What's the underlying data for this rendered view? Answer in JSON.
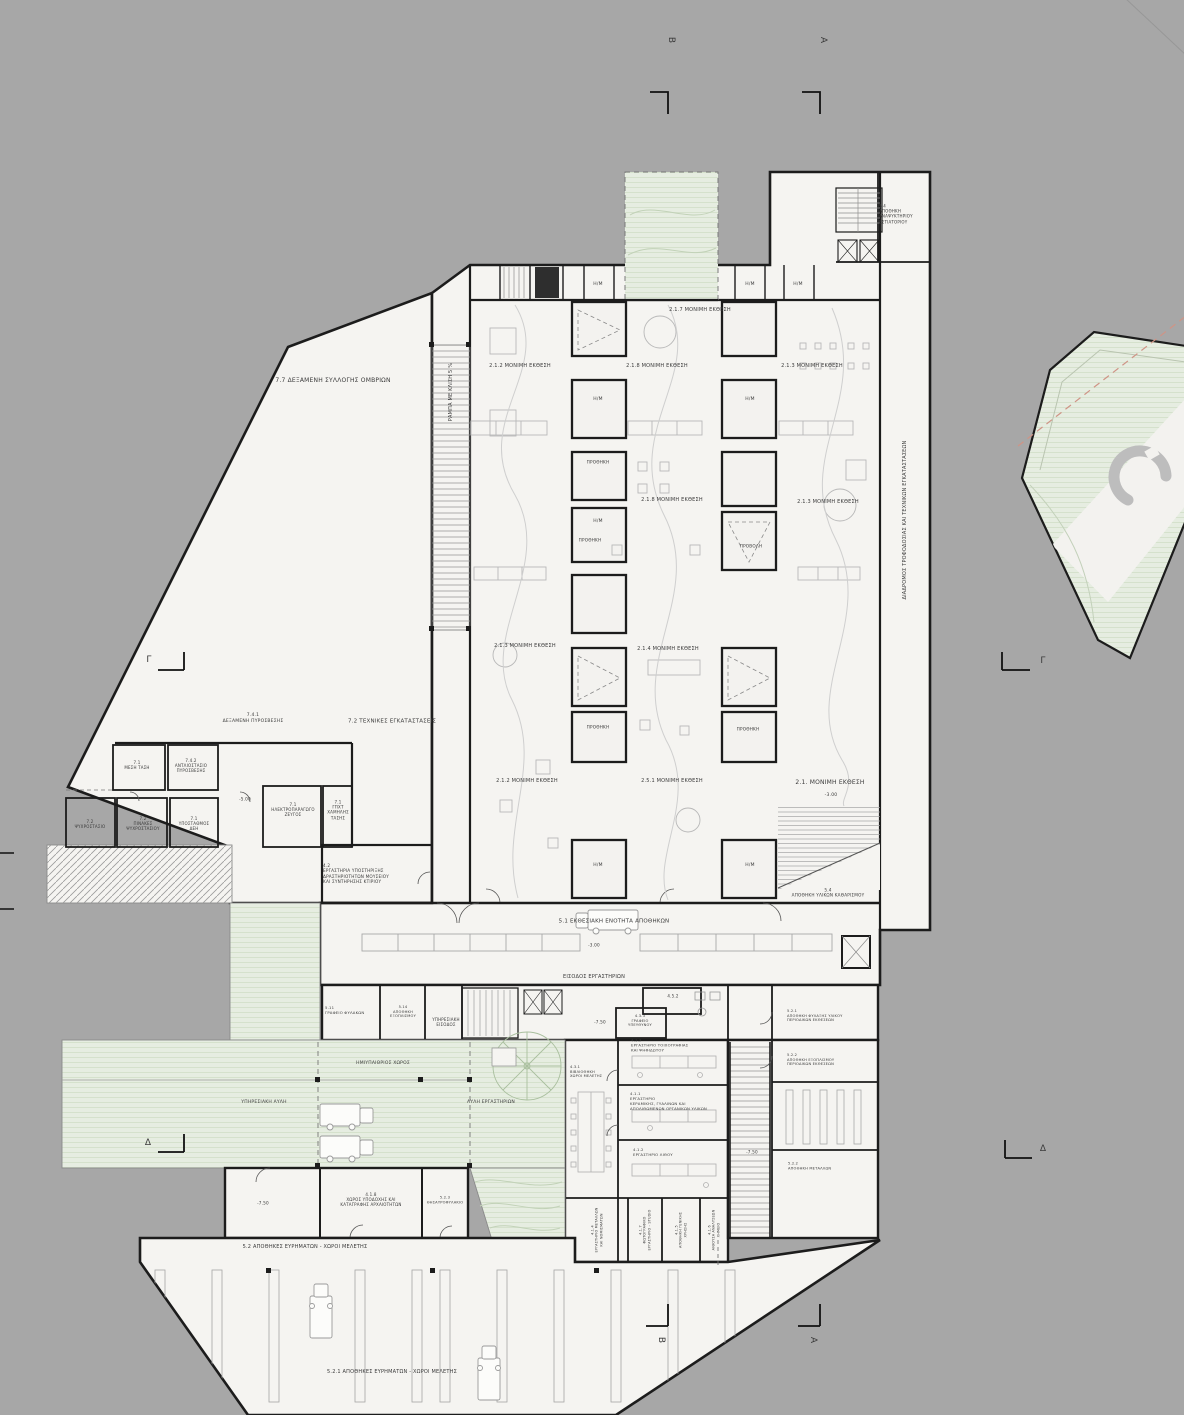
{
  "title": "Museum basement floor plan (Greek annotations)",
  "colors": {
    "background": "#a7a7a7",
    "paper": "#f5f4f1",
    "wall": "#1c1c1c",
    "green": "#e6ede1",
    "green_line": "#d5e1cc",
    "furniture": "#b5b5b5",
    "hatch": "#9b9b9b",
    "dashed_accent": "#cf9486",
    "text": "#3a3a3a"
  },
  "labels": [
    {
      "name": "section-letter-b-top",
      "text": "Β",
      "x": 670,
      "y": 40,
      "fs": 9,
      "rot": 90
    },
    {
      "name": "section-letter-a-top",
      "text": "Α",
      "x": 822,
      "y": 40,
      "fs": 9,
      "rot": 90
    },
    {
      "name": "section-letter-g-left",
      "text": "Γ",
      "x": 149,
      "y": 661,
      "fs": 9
    },
    {
      "name": "section-letter-g-right",
      "text": "Γ",
      "x": 1043,
      "y": 662,
      "fs": 9
    },
    {
      "name": "section-letter-d-left",
      "text": "Δ",
      "x": 148,
      "y": 1144,
      "fs": 9
    },
    {
      "name": "section-letter-d-right",
      "text": "Δ",
      "x": 1043,
      "y": 1150,
      "fs": 9
    },
    {
      "name": "section-letter-b-bottom",
      "text": "Β",
      "x": 660,
      "y": 1340,
      "fs": 9,
      "rot": 90
    },
    {
      "name": "section-letter-a-bottom",
      "text": "Α",
      "x": 812,
      "y": 1340,
      "fs": 9,
      "rot": 90
    },
    {
      "name": "room-7-7-rainwater-tank",
      "text": "7.7 ΔΕΞΑΜΕΝΗ ΣΥΛΛΟΓΗΣ ΟΜΒΡΙΩΝ",
      "x": 333,
      "y": 381,
      "fs": 6,
      "w": 220
    },
    {
      "name": "ramp-slope-label",
      "text": "ΡΑΜΠΑ ΜΕ ΚΛΙΣΗ 5 %",
      "x": 451,
      "y": 392,
      "fs": 5,
      "rot": -90,
      "w": 90
    },
    {
      "name": "exhibit-2-1-7",
      "text": "2.1.7 ΜΟΝΙΜΗ ΕΚΘΕΣΗ",
      "x": 700,
      "y": 310,
      "fs": 5,
      "w": 130
    },
    {
      "name": "exhibit-2-1-2-a",
      "text": "2.1.2 ΜΟΝΙΜΗ ΕΚΘΕΣΗ",
      "x": 520,
      "y": 366,
      "fs": 5,
      "w": 130
    },
    {
      "name": "exhibit-2-1-8-a",
      "text": "2.1.8 ΜΟΝΙΜΗ ΕΚΘΕΣΗ",
      "x": 657,
      "y": 366,
      "fs": 5,
      "w": 130
    },
    {
      "name": "exhibit-2-1-3-a",
      "text": "2.1.3 ΜΟΝΙΜΗ ΕΚΘΕΣΗ",
      "x": 812,
      "y": 366,
      "fs": 5,
      "w": 130
    },
    {
      "name": "exhibit-2-1-8-b",
      "text": "2.1.8 ΜΟΝΙΜΗ ΕΚΘΕΣΗ",
      "x": 672,
      "y": 500,
      "fs": 5,
      "w": 130
    },
    {
      "name": "exhibit-2-1-3-b",
      "text": "2.1.3 ΜΟΝΙΜΗ ΕΚΘΕΣΗ",
      "x": 828,
      "y": 502,
      "fs": 5,
      "w": 130
    },
    {
      "name": "exhibit-2-1-3-c",
      "text": "2.1.3 ΜΟΝΙΜΗ ΕΚΘΕΣΗ",
      "x": 525,
      "y": 646,
      "fs": 5,
      "w": 130
    },
    {
      "name": "exhibit-2-1-4",
      "text": "2.1.4 ΜΟΝΙΜΗ ΕΚΘΕΣΗ",
      "x": 668,
      "y": 649,
      "fs": 5,
      "w": 130
    },
    {
      "name": "exhibit-2-1-2-b",
      "text": "2.1.2 ΜΟΝΙΜΗ ΕΚΘΕΣΗ",
      "x": 527,
      "y": 781,
      "fs": 5,
      "w": 130
    },
    {
      "name": "exhibit-2-5-1",
      "text": "2.5.1 ΜΟΝΙΜΗ ΕΚΘΕΣΗ",
      "x": 672,
      "y": 781,
      "fs": 5,
      "w": 130
    },
    {
      "name": "exhibit-2-1-main",
      "text": "2.1. ΜΟΝΙΜΗ ΕΚΘΕΣΗ",
      "x": 830,
      "y": 783,
      "fs": 6,
      "w": 140
    },
    {
      "name": "level-marker",
      "text": "-3.00",
      "x": 831,
      "y": 796,
      "fs": 4.5
    },
    {
      "name": "hm-room-label",
      "text": "Η/Μ",
      "x": 598,
      "y": 285,
      "fs": 4.5
    },
    {
      "name": "hm-room-label",
      "text": "Η/Μ",
      "x": 750,
      "y": 285,
      "fs": 4.5
    },
    {
      "name": "hm-room-label",
      "text": "Η/Μ",
      "x": 798,
      "y": 285,
      "fs": 4.5
    },
    {
      "name": "hm-room-label",
      "text": "Η/Μ",
      "x": 598,
      "y": 400,
      "fs": 4.5
    },
    {
      "name": "hm-room-label",
      "text": "Η/Μ",
      "x": 750,
      "y": 400,
      "fs": 4.5
    },
    {
      "name": "hm-room-label",
      "text": "Η/Μ",
      "x": 598,
      "y": 522,
      "fs": 4.5
    },
    {
      "name": "hm-room-label",
      "text": "Η/Μ",
      "x": 598,
      "y": 866,
      "fs": 4.5
    },
    {
      "name": "hm-room-label",
      "text": "Η/Μ",
      "x": 750,
      "y": 866,
      "fs": 4.5
    },
    {
      "name": "showcase-label",
      "text": "ΠΡΟΘΗΚΗ",
      "x": 598,
      "y": 462,
      "fs": 4.2
    },
    {
      "name": "showcase-label",
      "text": "ΠΡΟΘΗΚΗ",
      "x": 590,
      "y": 540,
      "fs": 4.2
    },
    {
      "name": "projection-label",
      "text": "ΠΡΟΒΟΛΗ",
      "x": 751,
      "y": 546,
      "fs": 4.2
    },
    {
      "name": "showcase-label",
      "text": "ΠΡΟΘΗΚΗ",
      "x": 598,
      "y": 727,
      "fs": 4.2
    },
    {
      "name": "showcase-label",
      "text": "ΠΡΟΘΗΚΗ",
      "x": 748,
      "y": 729,
      "fs": 4.2
    },
    {
      "name": "supply-corridor-label",
      "text": "ΔΙΑΔΡΟΜΟΣ ΤΡΟΦΟΔΟΣΙΑΣ ΚΑΙ ΤΕΧΝΙΚΩΝ ΕΓΚΑΤΑΣΤΑΣΕΩΝ",
      "x": 905,
      "y": 520,
      "fs": 5,
      "rot": -90,
      "w": 300
    },
    {
      "name": "room-5-4-restaurant-store",
      "text": "5.4\nΑΠΟΘΗΚΗ\nΑΝΑΨΥΚΤΗΡΙΟΥ\nΕΣΤΙΑΤΟΡΙΟΥ",
      "x": 903,
      "y": 214,
      "fs": 4,
      "ta": "l",
      "w": 48
    },
    {
      "name": "room-5-4-cleaning-store",
      "text": "5.4\nΑΠΟΘΗΚΗ ΥΛΙΚΩΝ ΚΑΘΑΡΙΣΜΟΥ",
      "x": 828,
      "y": 893,
      "fs": 4.2,
      "w": 120
    },
    {
      "name": "room-7-4-1-fire-tank",
      "text": "7.4.1\nΔΕΞΑΜΕΝΗ ΠΥΡΟΣΒΕΣΗΣ",
      "x": 253,
      "y": 719,
      "fs": 4.5,
      "w": 100
    },
    {
      "name": "zone-7-2-technical",
      "text": "7.2 ΤΕΧΝΙΚΕΣ ΕΓΚΑΤΑΣΤΑΣΕΙΣ",
      "x": 392,
      "y": 722,
      "fs": 5.5,
      "w": 160
    },
    {
      "name": "room-7-1-medium-voltage",
      "text": "7.1\nΜΕΣΗ ΤΑΣΗ",
      "x": 137,
      "y": 765,
      "fs": 4,
      "w": 44
    },
    {
      "name": "room-7-4-2-fire-pumps",
      "text": "7.4.2\nΑΝΤΛΙΟΣΤΑΣΙΟ\nΠΥΡΟΣΒΕΣΗΣ",
      "x": 191,
      "y": 766,
      "fs": 4,
      "w": 48
    },
    {
      "name": "room-7-2-chiller",
      "text": "7.2\nΨΥΧΡΟΣΤΑΣΙΟ",
      "x": 90,
      "y": 824,
      "fs": 4,
      "w": 46
    },
    {
      "name": "room-7-2-chiller-panels",
      "text": "7.2\nΠΙΝΑΚΕΣ\nΨΥΧΡΟΣΤΑΣΙΟΥ",
      "x": 143,
      "y": 824,
      "fs": 4,
      "w": 46
    },
    {
      "name": "room-7-1-substation",
      "text": "7.1\nΥΠΟΣΤΑΘΜΟΣ\nΔΕΗ",
      "x": 194,
      "y": 824,
      "fs": 4,
      "w": 44
    },
    {
      "name": "room-7-1-generator",
      "text": "7.1\nΗΛΕΚΤΡΟΠΑΡΑΓΩΓΟ\nΖΕΥΓΟΣ",
      "x": 293,
      "y": 810,
      "fs": 4,
      "w": 56
    },
    {
      "name": "room-7-1-lv-panel",
      "text": "7.1\nΓΠΧΤ\nΧΑΜΗΛΗΣ\nΤΑΣΗΣ",
      "x": 338,
      "y": 810,
      "fs": 4,
      "w": 34
    },
    {
      "name": "level-marker",
      "text": "-5.00",
      "x": 245,
      "y": 799,
      "fs": 4.2
    },
    {
      "name": "room-4-2-support-labs",
      "text": "4.2\nΕΡΓΑΣΤΗΡΙΑ ΥΠΟΣΤΗΡΙΞΗΣ\nΔΡΑΣΤΗΡΙΟΤΗΤΩΝ ΜΟΥΣΕΙΟΥ\nΚΑΙ ΣΥΝΤΗΡΗΣΗΣ ΚΤΙΡΙΟΥ",
      "x": 378,
      "y": 874,
      "fs": 4.2,
      "ta": "l",
      "w": 110
    },
    {
      "name": "hall-5-1-storage-exhibition",
      "text": "5.1 ΕΚΘΕΣΙΑΚΗ ΕΝΟΤΗΤΑ ΑΠΟΘΗΚΩΝ",
      "x": 614,
      "y": 922,
      "fs": 5.5,
      "w": 220
    },
    {
      "name": "level-marker",
      "text": "-3.00",
      "x": 594,
      "y": 945,
      "fs": 4.2
    },
    {
      "name": "labs-entrance-label",
      "text": "ΕΙΣΟΔΟΣ ΕΡΓΑΣΤΗΡΙΩΝ",
      "x": 594,
      "y": 977,
      "fs": 5,
      "w": 130
    },
    {
      "name": "room-5-11-guards-office",
      "text": "5.11\nΓΡΑΦΕΙΟ ΦΥΛΑΚΩΝ",
      "x": 351,
      "y": 1011,
      "fs": 3.8,
      "ta": "l",
      "w": 52
    },
    {
      "name": "room-5-14-store",
      "text": "5.14\nΑΠΟΘΗΚΗ\nΕΞΟΠΛΙΣΜΟΥ",
      "x": 403,
      "y": 1012,
      "fs": 3.6,
      "w": 40
    },
    {
      "name": "service-entrance-label",
      "text": "ΥΠΗΡΕΣΙΑΚΗ\nΕΙΣΟΔΟΣ",
      "x": 446,
      "y": 1022,
      "fs": 4,
      "w": 46
    },
    {
      "name": "semi-open-space-label",
      "text": "ΗΜΙΥΠΑΙΘΡΙΟΣ ΧΩΡΟΣ",
      "x": 383,
      "y": 1064,
      "fs": 4.5,
      "w": 130
    },
    {
      "name": "service-yard-label",
      "text": "ΥΠΗΡΕΣΙΑΚΗ ΑΥΛΗ",
      "x": 264,
      "y": 1103,
      "fs": 4.5,
      "w": 110
    },
    {
      "name": "labs-yard-label",
      "text": "ΑΥΛΗ ΕΡΓΑΣΤΗΡΙΩΝ",
      "x": 491,
      "y": 1103,
      "fs": 4.5,
      "w": 110
    },
    {
      "name": "room-4-5-2",
      "text": "4.5.2",
      "x": 673,
      "y": 996,
      "fs": 4
    },
    {
      "name": "room-4-3-3-head-office",
      "text": "4.3.3\nΓΡΑΦΕΙΟ\nΥΠΕΥΘΥΝΟΥ",
      "x": 640,
      "y": 1021,
      "fs": 3.6,
      "w": 42
    },
    {
      "name": "level-marker",
      "text": "-7.50",
      "x": 600,
      "y": 1022,
      "fs": 4.2
    },
    {
      "name": "room-4-1-3-fresco-lab",
      "text": "4.1.3\nΕΡΓΑΣΤΗΡΙΟ ΤΟΙΧΟΓΡΑΦΙΑΣ\nΚΑΙ ΨΗΦΙΔΩΤΟΥ",
      "x": 676,
      "y": 1046,
      "fs": 3.8,
      "ta": "l",
      "w": 90
    },
    {
      "name": "room-4-1-1-ceramics-lab",
      "text": "4.1.1\nΕΡΓΑΣΤΗΡΙΟ\nΚΕΡΑΜΙΚΗΣ, ΓΥΑΛΙΝΩΝ ΚΑΙ\nΑΠΟΛΙΘΩΜΕΝΩΝ ΟΡΓΑΝΙΚΩΝ ΥΛΙΚΩΝ",
      "x": 676,
      "y": 1102,
      "fs": 3.8,
      "ta": "l",
      "w": 92
    },
    {
      "name": "room-4-1-2-stone-lab",
      "text": "4.1.2\nΕΡΓΑΣΤΗΡΙΟ ΛΙΘΟΥ",
      "x": 668,
      "y": 1153,
      "fs": 3.8,
      "ta": "l",
      "w": 70
    },
    {
      "name": "room-4-3-1-library",
      "text": "4.3.1\nΒΙΒΛΙΟΘΗΚΗ\nΧΩΡΟΙ ΜΕΛΕΤΗΣ",
      "x": 592,
      "y": 1072,
      "fs": 3.6,
      "ta": "l",
      "w": 44
    },
    {
      "name": "level-marker",
      "text": "-7.50",
      "x": 752,
      "y": 1152,
      "fs": 4.2
    },
    {
      "name": "room-5-2-1-periodic-store",
      "text": "5.2.1\nΑΠΟΘΗΚΗ ΦΥΛΑΞΗΣ ΥΛΙΚΟΥ\nΠΕΡΙΟΔΙΚΩΝ ΕΚΘΕΣΕΩΝ",
      "x": 830,
      "y": 1016,
      "fs": 3.6,
      "ta": "l",
      "w": 86
    },
    {
      "name": "room-5-2-2-equipment-store",
      "text": "5.2.2\nΑΠΟΘΗΚΗ ΕΞΟΠΛΙΣΜΟΥ\nΠΕΡΙΟΔΙΚΩΝ ΕΚΘΕΣΕΩΝ",
      "x": 830,
      "y": 1060,
      "fs": 3.6,
      "ta": "l",
      "w": 86
    },
    {
      "name": "room-5-2-2-metals-store",
      "text": "5.2.2\nΑΠΟΘΗΚΗ ΜΕΤΑΛΛΩΝ",
      "x": 828,
      "y": 1166,
      "fs": 3.6,
      "ta": "l",
      "w": 80
    },
    {
      "name": "room-4-1-8-reception",
      "text": "4.1.8\nΧΩΡΟΣ ΥΠΟΔΟΧΗΣ ΚΑΙ\nΚΑΤΑΓΡΑΦΗΣ ΑΡΧΑΙΟΤΗΤΩΝ",
      "x": 371,
      "y": 1200,
      "fs": 4,
      "w": 110
    },
    {
      "name": "room-5-2-3-vault",
      "text": "5.2.3\nΘΗΣΑΥΡΟΦΥΛΑΚΙΟ",
      "x": 445,
      "y": 1200,
      "fs": 3.6,
      "w": 44
    },
    {
      "name": "level-marker",
      "text": "-7.50",
      "x": 263,
      "y": 1203,
      "fs": 4.2
    },
    {
      "name": "zone-5-2-finds-store",
      "text": "5.2 ΑΠΟΘΗΚΕΣ ΕΥΡΗΜΑΤΩΝ - ΧΩΡΟΙ ΜΕΛΕΤΗΣ",
      "x": 305,
      "y": 1247,
      "fs": 5,
      "w": 260
    },
    {
      "name": "hall-5-2-1-finds-store",
      "text": "5.2.1 ΑΠΟΘΗΚΕΣ ΕΥΡΗΜΑΤΩΝ - ΧΩΡΟΙ ΜΕΛΕΤΗΣ",
      "x": 392,
      "y": 1372,
      "fs": 5,
      "w": 280
    },
    {
      "name": "room-4-1-4-metals-lab",
      "text": "4.1.4\nΕΡΓΑΣΤΗΡΙΟ ΜΕΤΑΛΛΩΝ\nΚΑΙ ΝΟΜΙΣΜΑΤΩΝ",
      "x": 597,
      "y": 1230,
      "fs": 3.4,
      "rot": -90,
      "w": 58
    },
    {
      "name": "room-4-1-7-photo-studio",
      "text": "4.1.7\nΦΩΤΟΓΡΑΦΙΚΟ\nΕΡΓΑΣΤΗΡΙΟ - STUDIO",
      "x": 645,
      "y": 1230,
      "fs": 3.4,
      "rot": -90,
      "w": 58
    },
    {
      "name": "room-4-1-5-general-store",
      "text": "4.1.5\nΑΠΟΘΗΚΗ ΓΕΝΙΚΗΣ\nΧΡΗΣΗΣ",
      "x": 681,
      "y": 1230,
      "fs": 3.4,
      "rot": -90,
      "w": 58
    },
    {
      "name": "room-4-1-6-chemistry-lab",
      "text": "4.1.6\nΑΙΘΟΥΣΑ ΑΝΑΛΥΣΕΩΝ\nΧΗΜΕΙΟ",
      "x": 714,
      "y": 1230,
      "fs": 3.4,
      "rot": -90,
      "w": 58
    }
  ]
}
